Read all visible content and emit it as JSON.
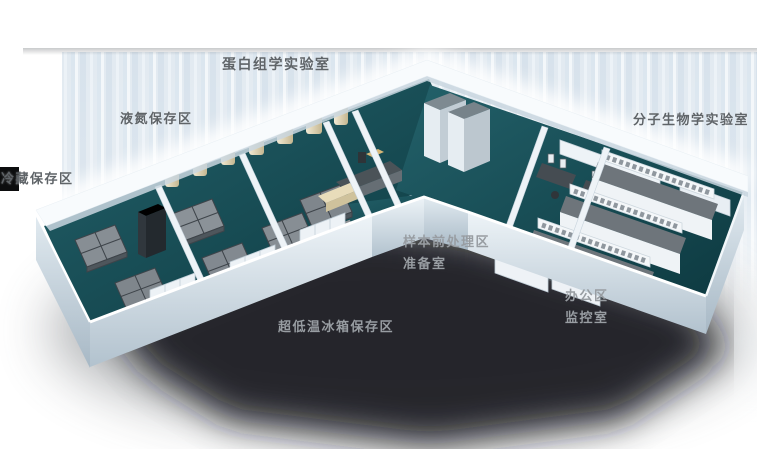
{
  "labels": {
    "proteomics_lab": "蛋白组学实验室",
    "liquid_nitrogen_storage": "液氮保存区",
    "cold_storage": "冷藏保存区",
    "molecular_biology_lab": "分子生物学实验室",
    "sample_pretreatment": "样本前处理区",
    "prep_room": "准备室",
    "office": "办公区",
    "monitoring_room": "监控室",
    "ulf_freezer_storage": "超低温冰箱保存区"
  },
  "colors": {
    "floor_teal": "#17494f",
    "wall_light": "#eef4f8",
    "wall_shaded": "#b7c6d1",
    "label_dark": "#5f6468",
    "label_on_shadow": "#989da2",
    "tank_body": "#e9dfc6",
    "tank_cap": "#3f6fb0",
    "equipment_gray": "#878e94",
    "bench_top": "#6e757b",
    "background_panel": "#dde7f0",
    "shadow": "#14171a"
  }
}
